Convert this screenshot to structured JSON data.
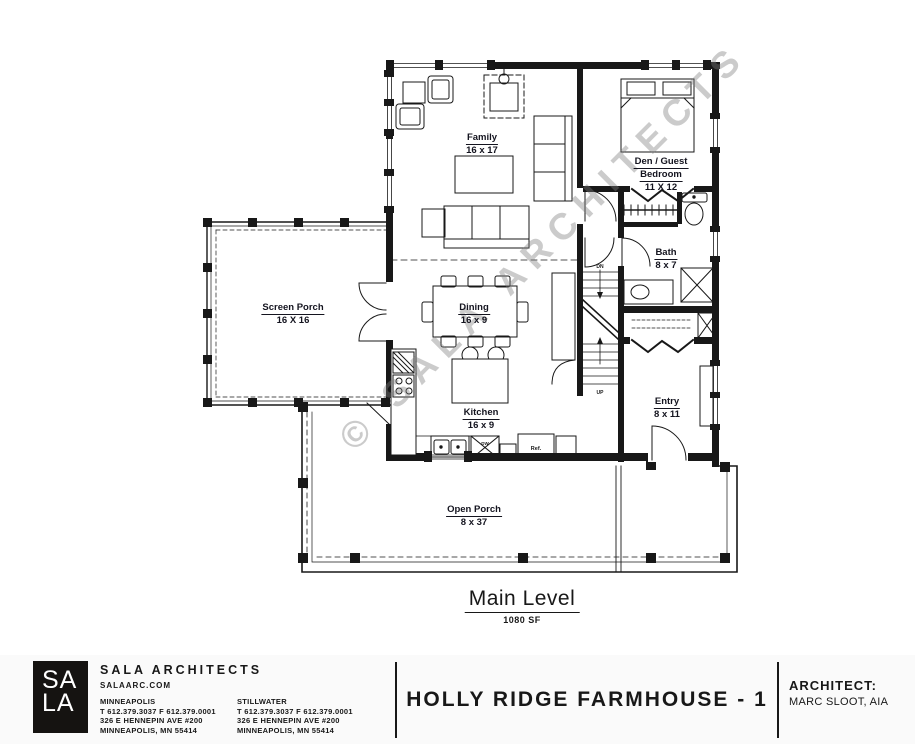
{
  "plan": {
    "watermark": "© SALA ARCHITECTS",
    "title": "Main Level",
    "area": "1080 SF",
    "rooms": [
      {
        "label": "Family",
        "dims": "16 x 17"
      },
      {
        "label": "Den / Guest",
        "label2": "Bedroom",
        "dims": "11 X 12"
      },
      {
        "label": "Bath",
        "dims": "8 x 7"
      },
      {
        "label": "Screen Porch",
        "dims": "16 X 16"
      },
      {
        "label": "Dining",
        "dims": "16 x 9"
      },
      {
        "label": "Kitchen",
        "dims": "16 x 9"
      },
      {
        "label": "Entry",
        "dims": "8 x 11"
      },
      {
        "label": "Open Porch",
        "dims": "8 x 37"
      }
    ],
    "annotations": {
      "refrigerator": "Ref.",
      "dishwasher": "DW",
      "stairs_down": "DN",
      "stairs_up": "UP"
    }
  },
  "footer": {
    "logo": {
      "line1": "SA",
      "line2": "LA"
    },
    "firm_name": "SALA ARCHITECTS",
    "website": "SALAARC.COM",
    "offices": [
      {
        "city": "MINNEAPOLIS",
        "phone": "T 612.379.3037   F 612.379.0001",
        "address1": "326 E HENNEPIN AVE #200",
        "address2": "MINNEAPOLIS, MN 55414"
      },
      {
        "city": "STILLWATER",
        "phone": "T 612.379.3037   F 612.379.0001",
        "address1": "326 E HENNEPIN AVE #200",
        "address2": "MINNEAPOLIS, MN 55414"
      }
    ],
    "project_title": "HOLLY RIDGE FARMHOUSE - 1",
    "architect_label": "ARCHITECT:",
    "architect_name": "MARC SLOOT, AIA"
  },
  "colors": {
    "ink": "#181818",
    "watermark_gray": "#7d7d7d",
    "footer_bg": "#fafafa"
  }
}
